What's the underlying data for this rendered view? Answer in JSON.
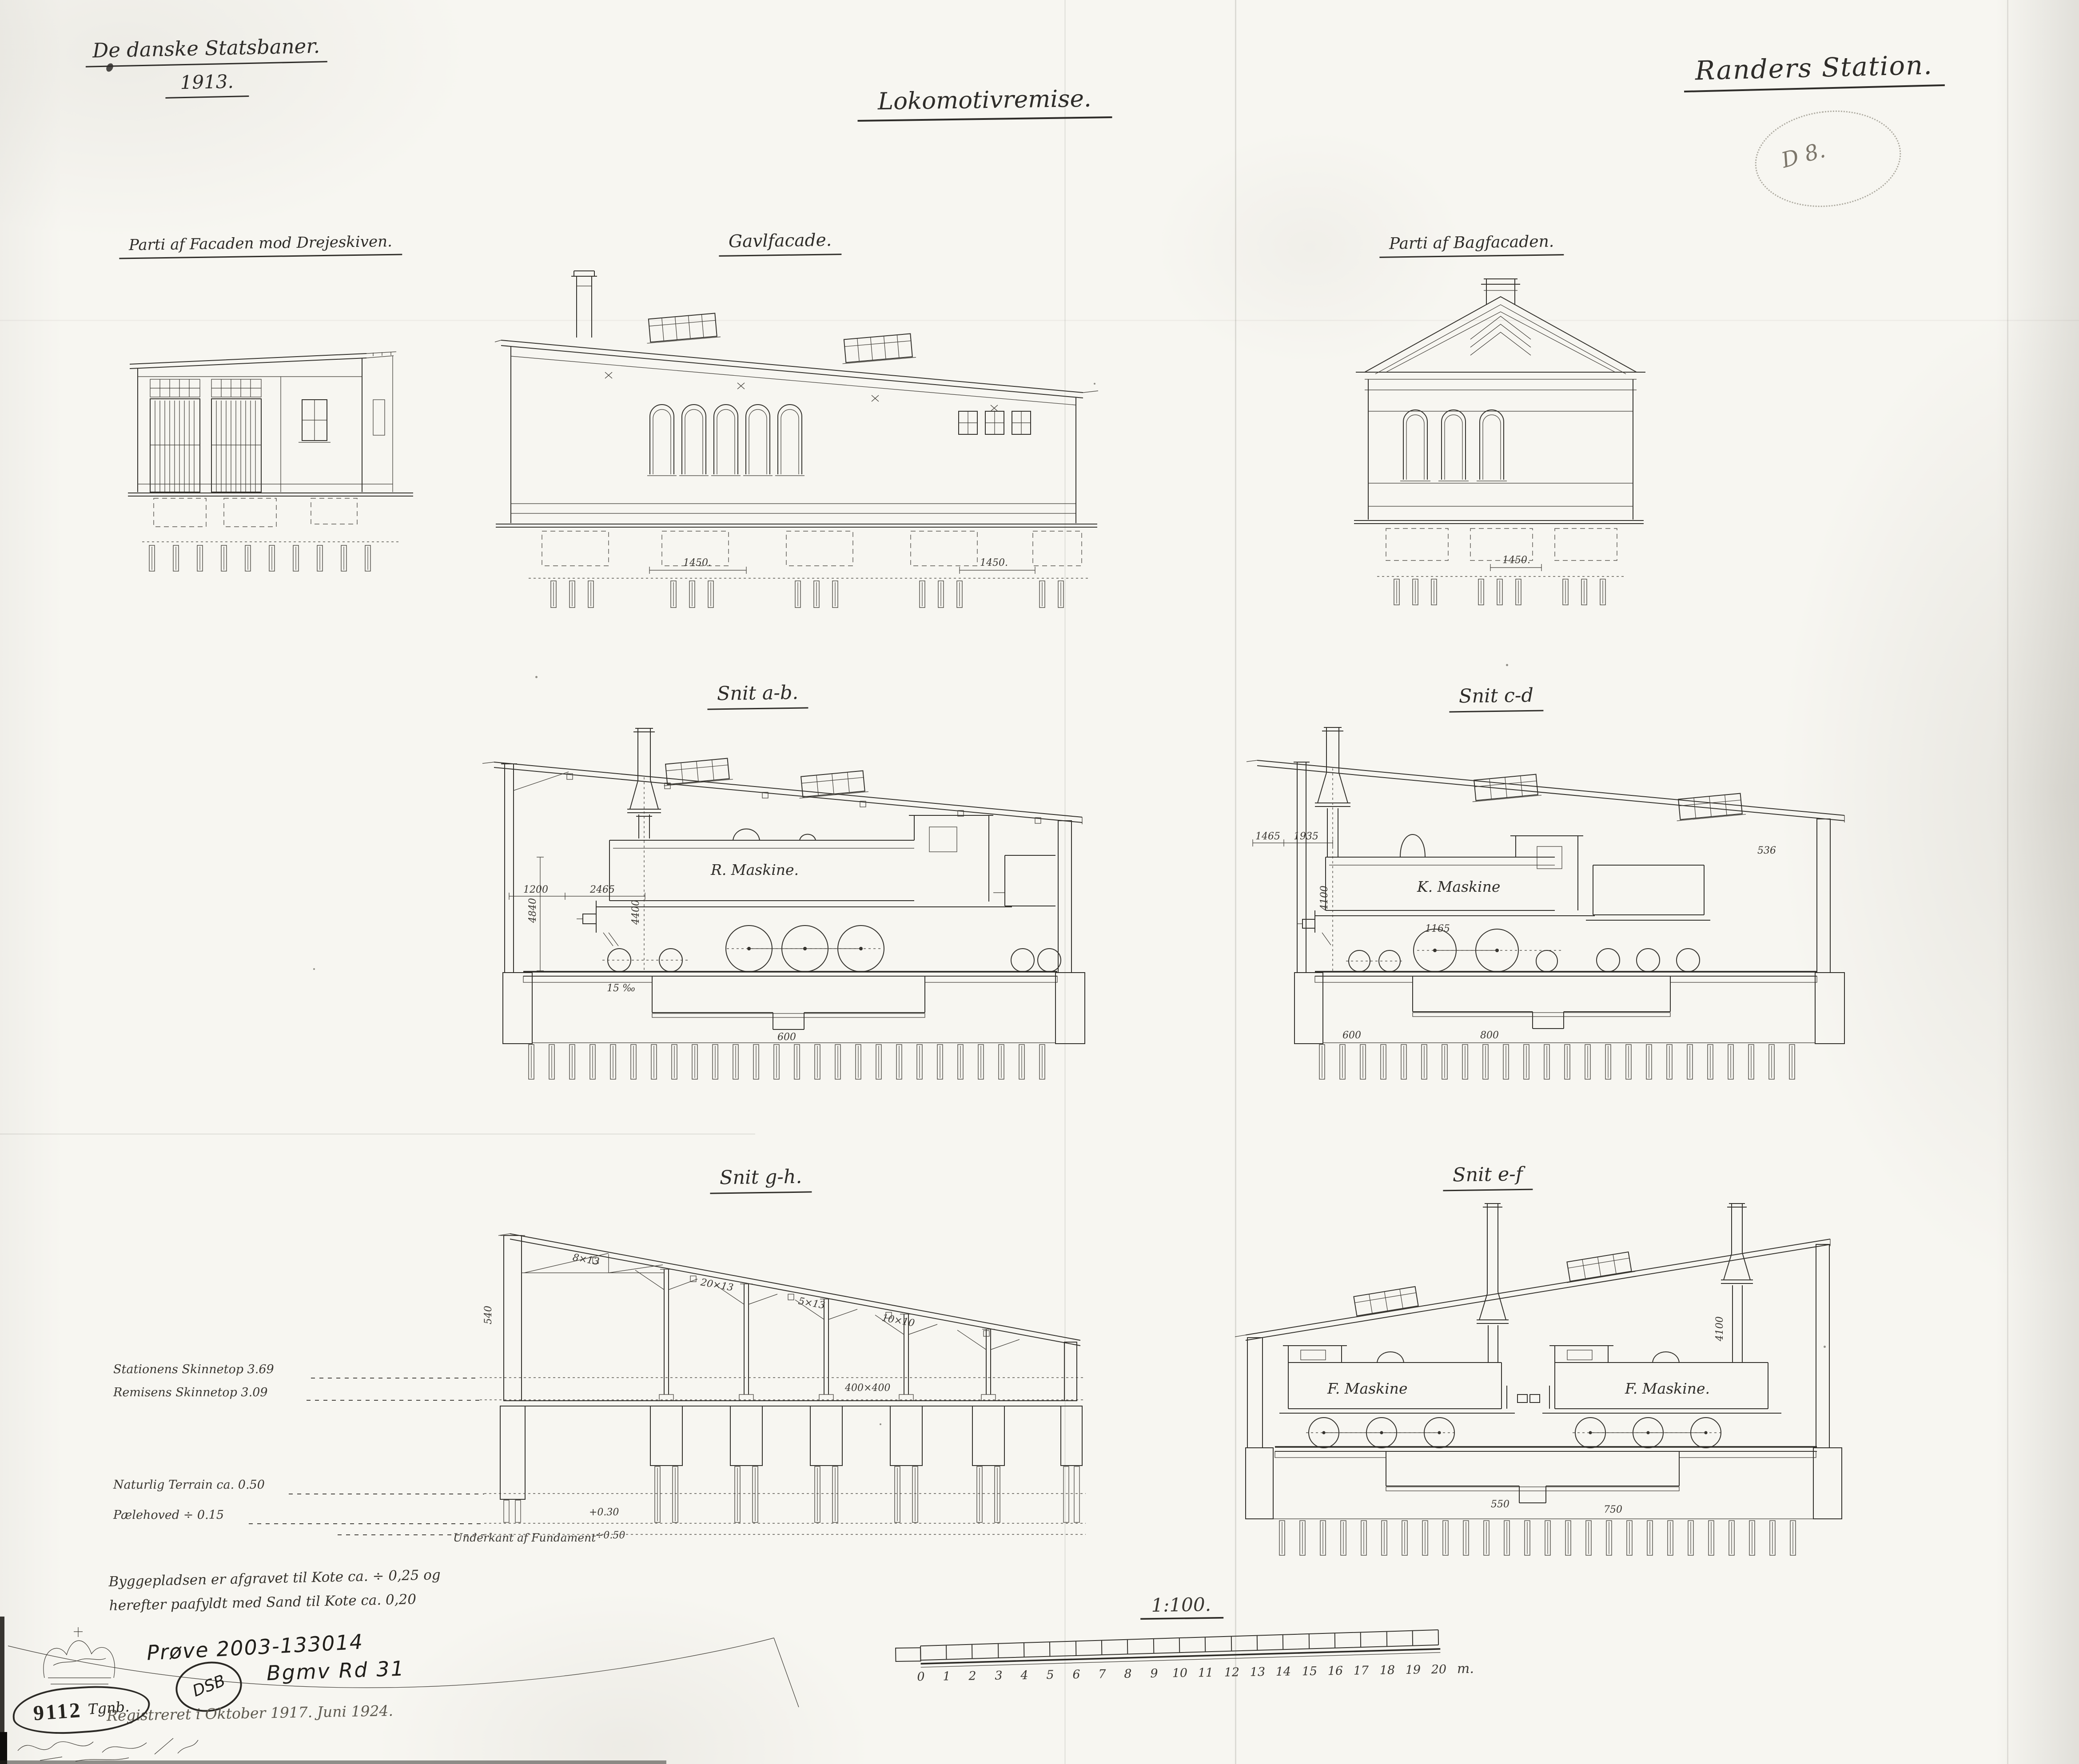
{
  "page": {
    "bg": "#f7f6f1",
    "ink": "#2e2c29",
    "faint": "#8f8b81"
  },
  "header": {
    "org_line1": "De danske Statsbaner.",
    "org_line2": "1913.",
    "drawing_title": "Lokomotivremise.",
    "station_title": "Randers Station.",
    "round_stamp_text": "D 8."
  },
  "views": {
    "facade_drejeskive": {
      "label": "Parti af Facaden mod Drejeskiven."
    },
    "gavlfacade": {
      "label": "Gavlfacade.",
      "dim_left": "1450.",
      "dim_right": "1450."
    },
    "bagfacade": {
      "label": "Parti af Bagfacaden.",
      "dim": "1450."
    },
    "snit_ab": {
      "label": "Snit a-b.",
      "machine_label": "R. Maskine.",
      "dim_1200": "1200",
      "dim_2465": "2465",
      "dim_4400": "4400",
      "dim_4840": "4840",
      "dim_600": "600",
      "slope": "15 ‰"
    },
    "snit_cd": {
      "label": "Snit c-d",
      "machine_label": "K. Maskine",
      "dim_1465": "1465",
      "dim_1935": "1935",
      "dim_4100": "4100",
      "dim_536": "536",
      "dim_1165": "1165",
      "dim_600": "600",
      "dim_800": "800"
    },
    "snit_gh": {
      "label": "Snit g-h.",
      "dim_540": "540",
      "truss_dims": [
        "8×13",
        "20×13",
        "5×13",
        "10×10",
        "400×400"
      ],
      "level_plus": "+0.30",
      "level_minus": "÷0.50"
    },
    "snit_ef": {
      "label": "Snit e-f",
      "machine_label_1": "F. Maskine",
      "machine_label_2": "F. Maskine.",
      "dim_4100": "4100",
      "dim_750": "750",
      "dim_550": "550"
    }
  },
  "levels": {
    "station_rail": "Stationens Skinnetop 3.69",
    "shed_rail": "Remisens Skinnetop 3.09",
    "terrain": "Naturlig Terrain ca. 0.50",
    "pile_head": "Pælehoved ÷ 0.15",
    "foundation": "Underkant af Fundament"
  },
  "footnote": {
    "line1": "Byggepladsen er afgravet til Kote ca. ÷ 0,25 og",
    "line2": "herefter paafyldt med Sand til Kote ca. 0,20"
  },
  "scale_bar": {
    "title": "1:100.",
    "ticks": [
      "0",
      "1",
      "2",
      "3",
      "4",
      "5",
      "6",
      "7",
      "8",
      "9",
      "10",
      "11",
      "12",
      "13",
      "14",
      "15",
      "16",
      "17",
      "18",
      "19",
      "20"
    ],
    "unit": "m."
  },
  "annotations": {
    "archive_no": "Prøve 2003-133014",
    "dsb_mark": "DSB",
    "inventory_no": "Bgmv Rd 31",
    "registered": "Registreret i Oktober 1917.  Juni 1924.",
    "stamp_number": "9112",
    "stamp_label": "Tgnb."
  }
}
